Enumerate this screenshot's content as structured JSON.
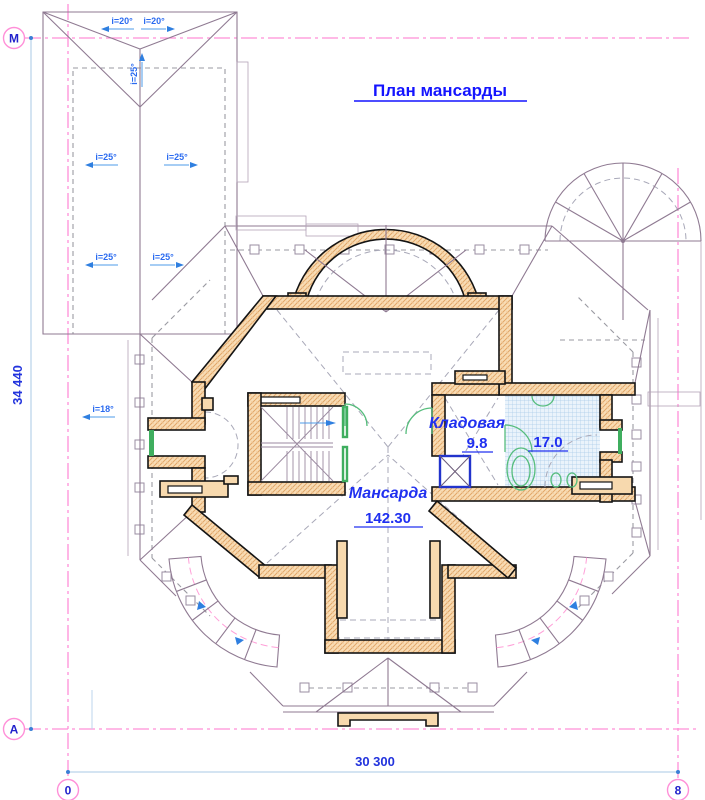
{
  "title": "План мансарды",
  "rooms": {
    "attic": {
      "name": "Мансарда",
      "area": "142.30"
    },
    "storage": {
      "name": "Кладовая",
      "area": "9.8"
    },
    "bathroom": {
      "area": "17.0"
    }
  },
  "dimensions": {
    "height_total": "34 440",
    "width_total": "30 300"
  },
  "axis_markers": [
    {
      "label": "М",
      "x": 14,
      "y": 38
    },
    {
      "label": "А",
      "x": 14,
      "y": 729
    },
    {
      "label": "0",
      "x": 68,
      "y": 790
    },
    {
      "label": "8",
      "x": 678,
      "y": 790
    }
  ],
  "slope_annotations": [
    {
      "text": "i=20°",
      "x": 122,
      "y": 24,
      "rot": 0,
      "dir": "left"
    },
    {
      "text": "i=20°",
      "x": 154,
      "y": 24,
      "rot": 0,
      "dir": "right"
    },
    {
      "text": "i=25°",
      "x": 137,
      "y": 74,
      "rot": -90,
      "dir": "right"
    },
    {
      "text": "i=25°",
      "x": 106,
      "y": 160,
      "rot": 0,
      "dir": "left"
    },
    {
      "text": "i=25°",
      "x": 177,
      "y": 160,
      "rot": 0,
      "dir": "right"
    },
    {
      "text": "i=25°",
      "x": 106,
      "y": 260,
      "rot": 0,
      "dir": "left"
    },
    {
      "text": "i=25°",
      "x": 163,
      "y": 260,
      "rot": 0,
      "dir": "right"
    },
    {
      "text": "i=18°",
      "x": 103,
      "y": 412,
      "rot": 0,
      "dir": "left"
    }
  ],
  "colors": {
    "axis_pink": "#ff8fd8",
    "label_blue": "#2030f0",
    "wall_tan": "#f7d9ae",
    "roof_purple": "#8f7a92",
    "bath_hatch_blue": "#a9cbe9",
    "window_green": "#3fae5f",
    "shaft_blue": "#2233cc",
    "dim_line_blue": "#a9c9e6"
  }
}
